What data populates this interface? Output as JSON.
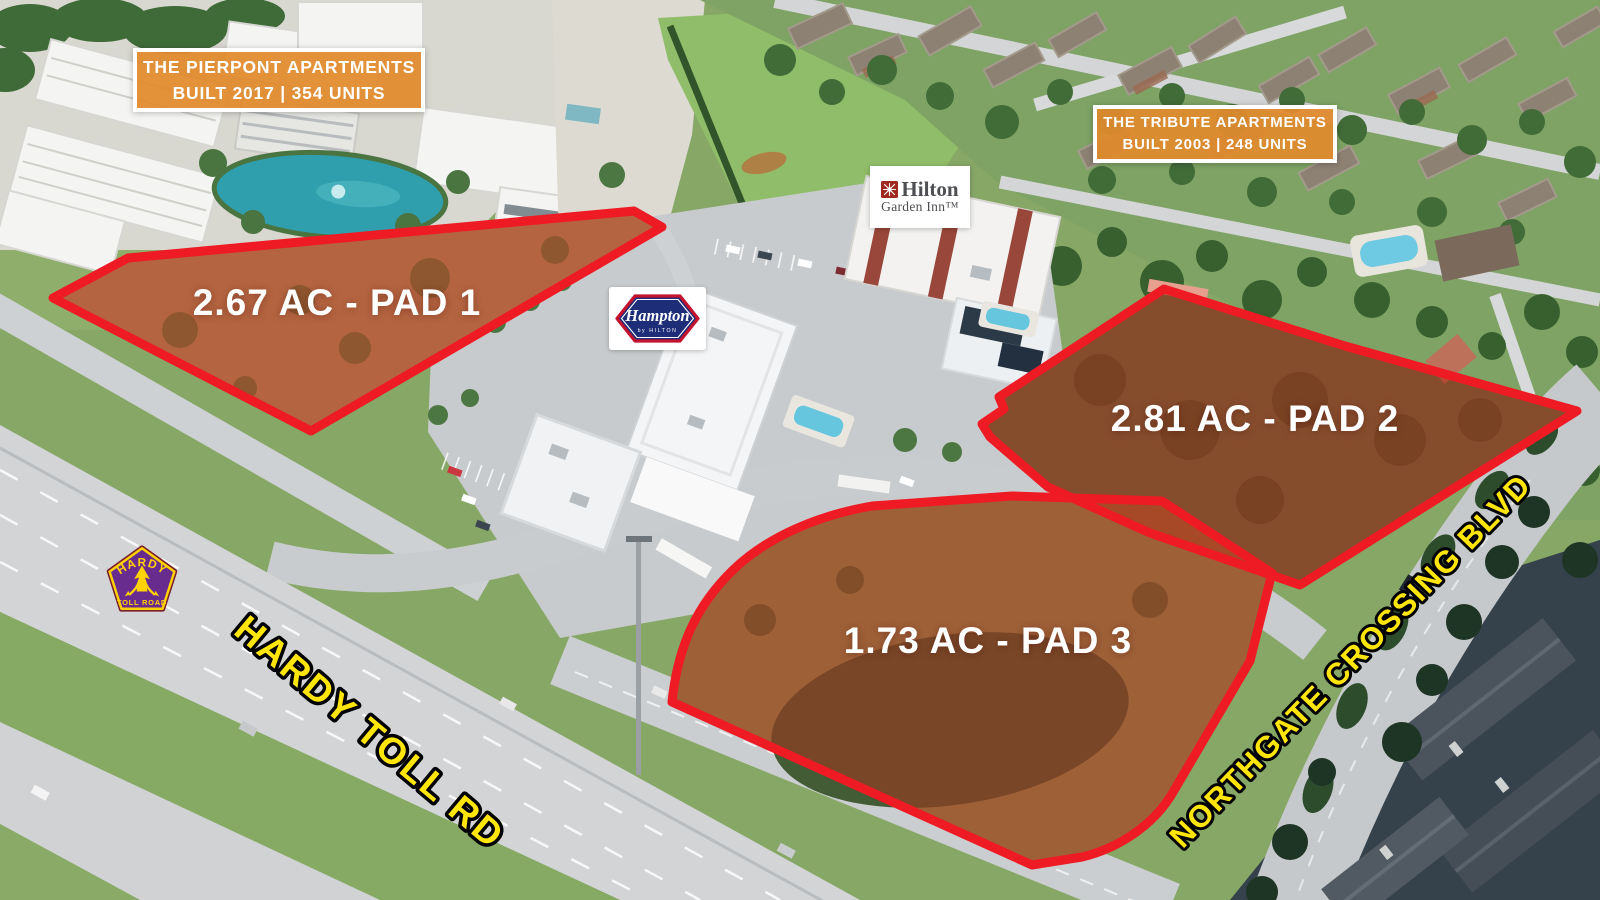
{
  "title": "Hotel pad sites aerial marketing map",
  "banners": {
    "pierpont": {
      "line1": "THE PIERPONT APARTMENTS",
      "line2": "BUILT 2017 | 354 UNITS"
    },
    "tribute": {
      "line1": "THE TRIBUTE APARTMENTS",
      "line2": "BUILT 2003 | 248 UNITS"
    }
  },
  "pad_sites": {
    "items": [
      {
        "id": "pad-1",
        "label": "2.67 AC - PAD 1"
      },
      {
        "id": "pad-2",
        "label": "2.81 AC - PAD 2"
      },
      {
        "id": "pad-3",
        "label": "1.73 AC - PAD 3"
      }
    ]
  },
  "road_labels": {
    "hardy": "HARDY TOLL RD",
    "northgate": "NORTHGATE CROSSING BLVD"
  },
  "logos": {
    "hilton_garden_inn": {
      "line1": "Hilton",
      "line2": "Garden Inn™"
    },
    "hampton": {
      "name": "Hampton",
      "byline": "by HILTON"
    },
    "hardy_shield": {
      "top": "HARDY",
      "bottom": "TOLL ROAD"
    }
  },
  "colors": {
    "pad_outline_red": "#ee1b24",
    "pad_overlay_red": "#b03018",
    "banner_orange": "#e28a2b",
    "road_label_yellow": "#ffe50a",
    "shield_purple": "#672c8e",
    "shield_yellow": "#ffd200",
    "hampton_navy": "#1e2d78",
    "hampton_red": "#c3132e",
    "pond_teal": "#2f9fae"
  }
}
